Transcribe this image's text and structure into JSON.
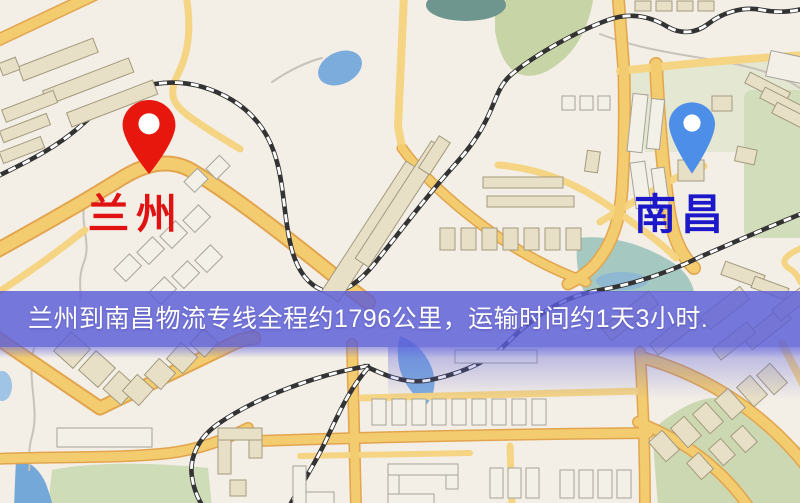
{
  "banner": {
    "text": "兰州到南昌物流专线全程约1796公里，运输时间约1天3小时.",
    "distance": "1796公里",
    "duration": "1天3小时"
  },
  "markers": {
    "origin": {
      "label": "兰州",
      "pin_icon": "red-location-pin-icon",
      "pin_color": "#E8170D",
      "label_color": "#E01212"
    },
    "destination": {
      "label": "南昌",
      "pin_icon": "blue-location-pin-icon",
      "pin_color": "#4D8EE8",
      "label_color": "#1C18C9"
    }
  },
  "theme": {
    "base": "#F3EEE6",
    "road_fill": "#F4CC70",
    "road_casing": "#E2A54E",
    "road_minor": "#F5D483",
    "railway": "#333333",
    "water": "#7CACDC",
    "green": "#C7D4A5",
    "green_pale": "#DDE4C9",
    "building_beige": "#E8E0C6",
    "building_stroke": "#A39A7E",
    "building_white": "#F3F0E8",
    "banner_bg": "#5A5DD8",
    "banner_text": "#FFFFFF",
    "pin_red": "#E8170D",
    "pin_blue": "#4D8EE8",
    "label_red": "#E01212",
    "label_blue": "#1C18C9"
  }
}
